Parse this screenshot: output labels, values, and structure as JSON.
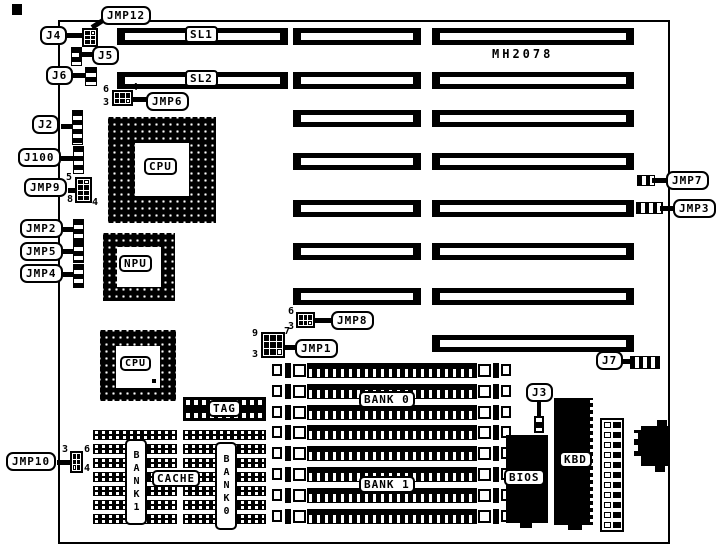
{
  "board": {
    "model": "MH2078"
  },
  "callouts": {
    "jmp12": "JMP12",
    "j4": "J4",
    "j5": "J5",
    "j6": "J6",
    "jmp6": "JMP6",
    "j2": "J2",
    "j100": "J100",
    "jmp9": "JMP9",
    "jmp2": "JMP2",
    "jmp5": "JMP5",
    "jmp4": "JMP4",
    "jmp10": "JMP10",
    "jmp8": "JMP8",
    "jmp1": "JMP1",
    "jmp7": "JMP7",
    "jmp3": "JMP3",
    "j7": "J7",
    "j3": "J3"
  },
  "slots": {
    "sl1": "SL1",
    "sl2": "SL2",
    "isa_rows": 8
  },
  "chips": {
    "cpu": "CPU",
    "npu": "NPU",
    "cpu2": "CPU",
    "tag": "TAG",
    "cache": "CACHE",
    "bios": "BIOS",
    "kbd": "KBD"
  },
  "memory": {
    "bank0": "BANK 0",
    "bank1": "BANK 1",
    "bank0_vertical": "BANK0",
    "bank1_vertical": "BANK1",
    "simm_rows": 8,
    "cache_rows_per_block": 7
  },
  "pin_numbers": {
    "jmp6": {
      "top_left": "6",
      "top_right": "4",
      "bottom_left": "3"
    },
    "jmp9": {
      "top_left": "5",
      "bottom_left": "8",
      "bottom_right": "4"
    },
    "jmp8": {
      "top_left": "6",
      "bottom_left": "3"
    },
    "jmp1": {
      "top_left": "9",
      "top_right": "7",
      "bottom_left": "3"
    },
    "jmp10": {
      "top_left": "3",
      "top_right": "6",
      "bottom_right": "4"
    }
  },
  "power_connector_pins": 11,
  "colors": {
    "ink": "#000000",
    "paper": "#ffffff"
  }
}
